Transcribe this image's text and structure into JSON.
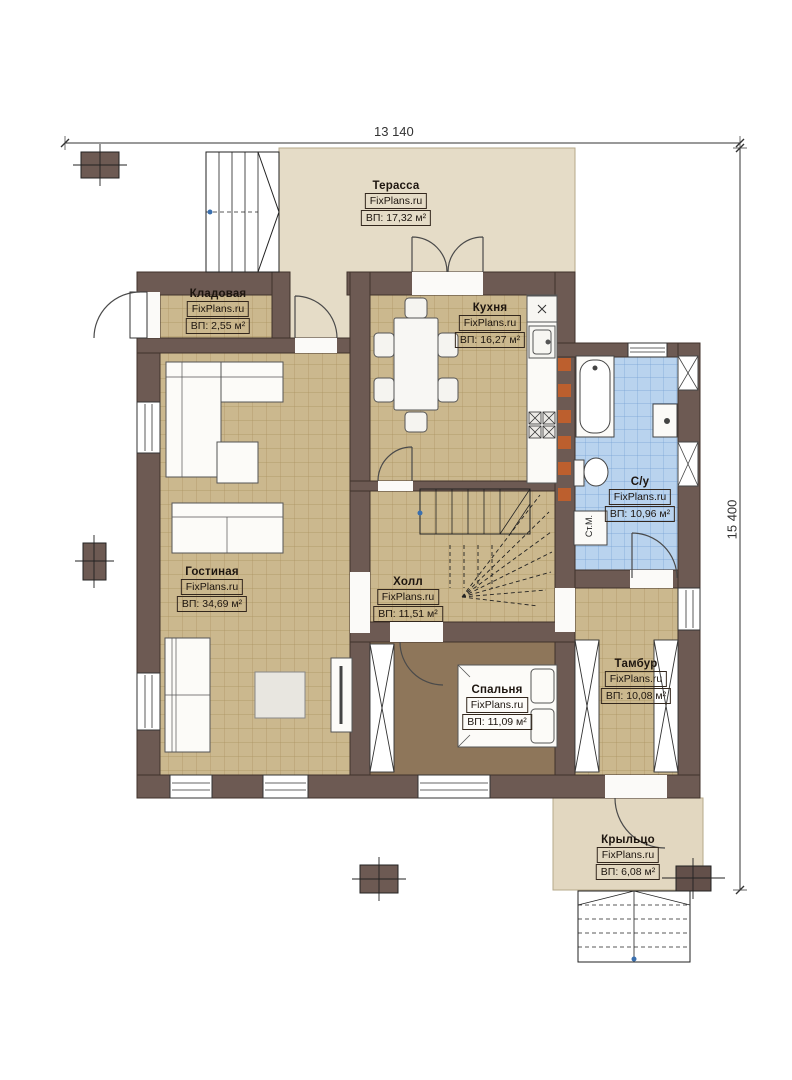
{
  "plan": {
    "brand": "FixPlans.ru",
    "dimensions": {
      "width": "13 140",
      "height": "15 400"
    },
    "rooms": {
      "terrace": {
        "name": "Терасса",
        "area": "ВП: 17,32 м²"
      },
      "storage": {
        "name": "Кладовая",
        "area": "ВП: 2,55 м²"
      },
      "kitchen": {
        "name": "Кухня",
        "area": "ВП: 16,27 м²"
      },
      "bathroom": {
        "name": "С/у",
        "area": "ВП: 10,96 м²"
      },
      "living": {
        "name": "Гостиная",
        "area": "ВП: 34,69 м²"
      },
      "hall": {
        "name": "Холл",
        "area": "ВП: 11,51 м²"
      },
      "vestibule": {
        "name": "Тамбур",
        "area": "ВП: 10,08 м²"
      },
      "bedroom": {
        "name": "Спальня",
        "area": "ВП: 11,09 м²"
      },
      "porch": {
        "name": "Крыльцо",
        "area": "ВП: 6,08 м²"
      }
    },
    "annotations": {
      "washing_machine": "Ст.М."
    },
    "colors": {
      "wall": "#6d5a53",
      "floor_tan": "#cbb88e",
      "floor_blue": "#b9d3ee",
      "floor_bedroom": "#8e765a",
      "outdoor": "#e5dcc7",
      "accent_orange": "#bc5f2e"
    }
  }
}
